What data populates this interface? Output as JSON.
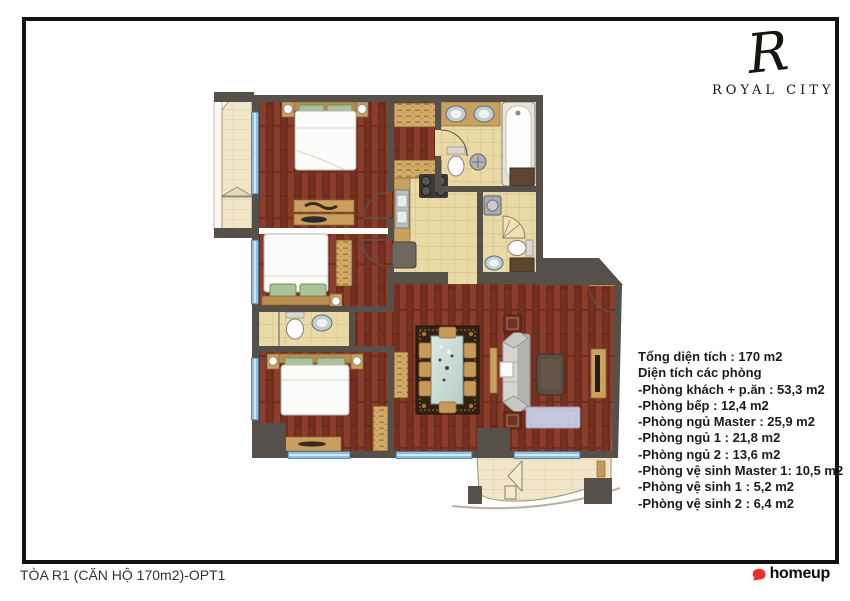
{
  "brand": {
    "monogram": "R",
    "name": "ROYAL CITY"
  },
  "areas": {
    "title": "Tổng diện tích : 170 m2",
    "subtitle": "Diện tích các phòng",
    "rooms": [
      "-Phòng khách + p.ăn : 53,3 m2",
      "-Phòng bếp : 12,4 m2",
      "-Phòng ngủ Master : 25,9 m2",
      "-Phòng ngủ 1 : 21,8 m2",
      "-Phòng ngủ 2 : 13,6 m2",
      "-Phòng vệ sinh Master 1: 10,5 m2",
      "-Phòng vệ sinh 1 : 5,2 m2",
      "-Phòng vệ sinh 2 : 6,4 m2"
    ]
  },
  "footer": {
    "plan_title": "TÒA R1 (CĂN HỘ 170m2)-OPT1",
    "watermark": "homeup"
  },
  "colors": {
    "wood_floor": "#7e3424",
    "tile_floor": "#eadaa6",
    "balcony_tile": "#f1e7c8",
    "wall": "#56504a",
    "window_blue": "#8fc0dd",
    "furniture_tan": "#caa05e",
    "homeup_red": "#e6332a",
    "text": "#1c1c1c"
  }
}
